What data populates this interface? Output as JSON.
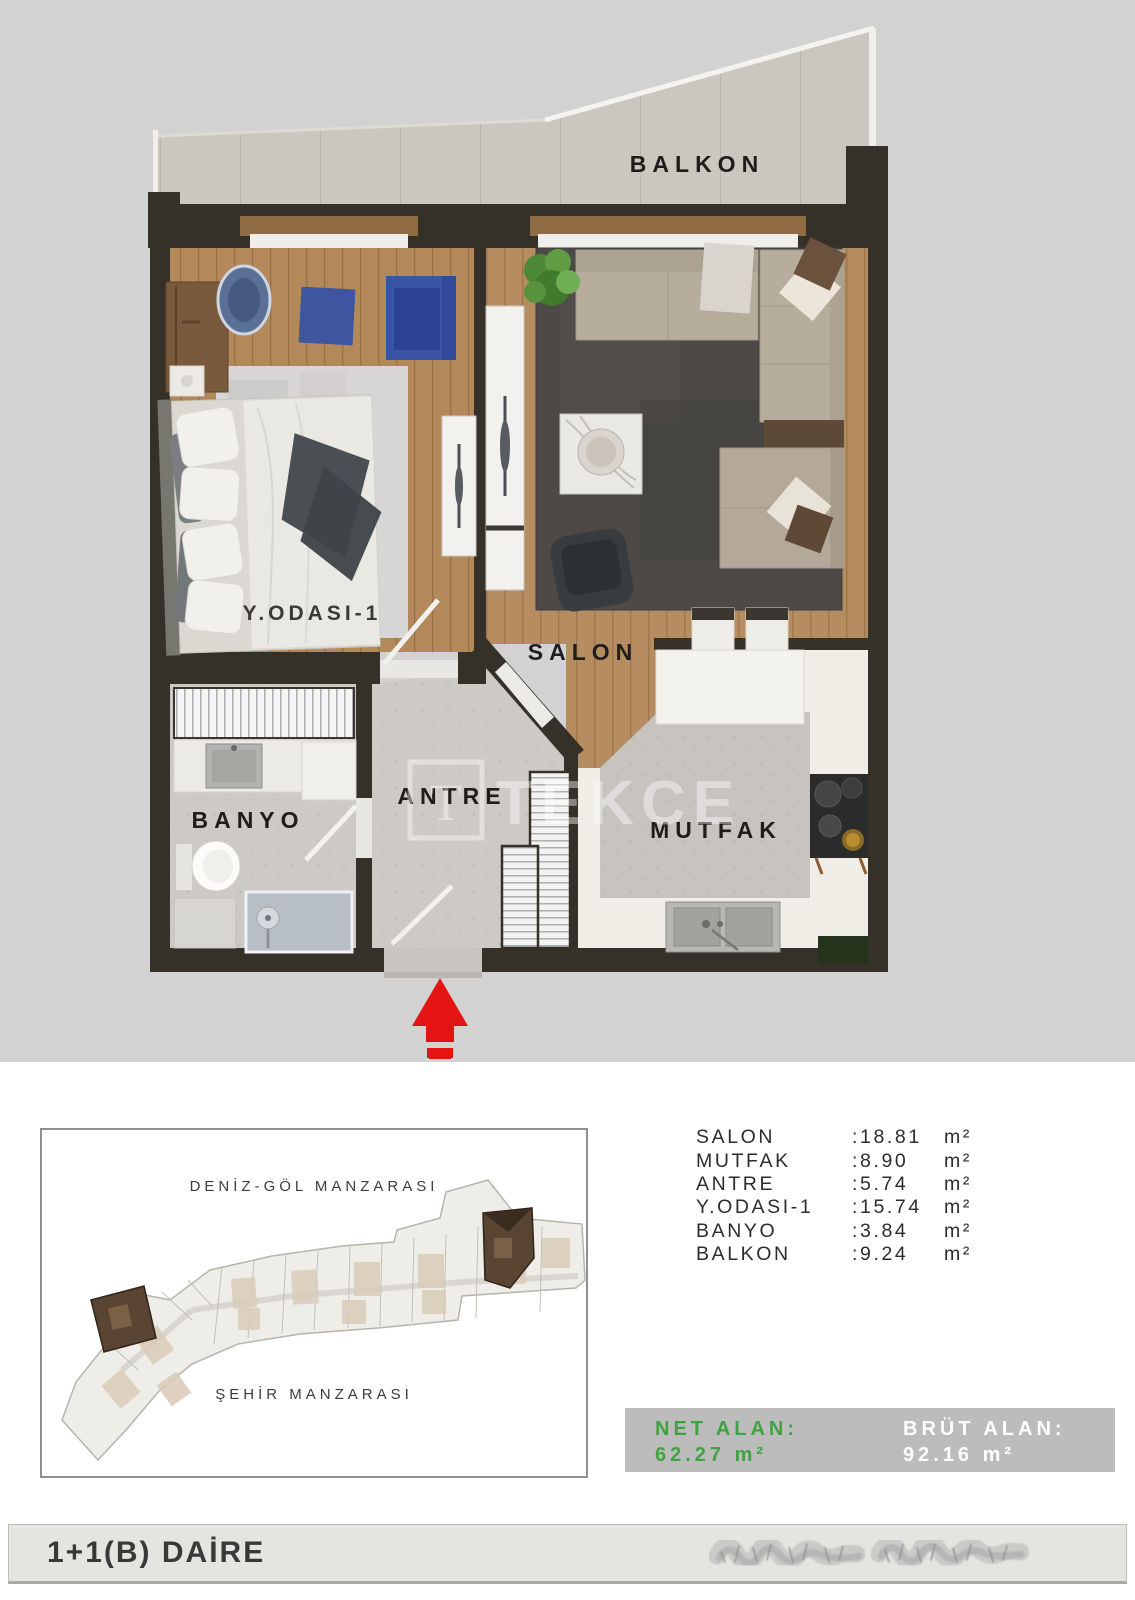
{
  "floor_plan": {
    "labels": {
      "balkon": "BALKON",
      "salon": "SALON",
      "bedroom": "Y.ODASI-1",
      "antre": "ANTRE",
      "banyo": "BANYO",
      "mutfak": "MUTFAK"
    },
    "watermark": {
      "logo_letter": "T",
      "text": "TEKCE"
    },
    "entrance_arrow_color": "#e41414"
  },
  "site_plan": {
    "sea_lake_view_label": "DENİZ-GÖL MANZARASI",
    "city_view_label": "ŞEHİR MANZARASI"
  },
  "areas": {
    "rows": [
      {
        "label": "SALON",
        "value": ":18.81",
        "unit": "m²"
      },
      {
        "label": "MUTFAK",
        "value": ":8.90",
        "unit": "m²"
      },
      {
        "label": "ANTRE",
        "value": ":5.74",
        "unit": "m²"
      },
      {
        "label": "Y.ODASI-1",
        "value": ":15.74",
        "unit": "m²"
      },
      {
        "label": "BANYO",
        "value": ":3.84",
        "unit": "m²"
      },
      {
        "label": "BALKON",
        "value": ":9.24",
        "unit": "m²"
      }
    ]
  },
  "summary": {
    "net_label": "NET ALAN:",
    "net_value": "62.27 m²",
    "net_color": "#3fa43f",
    "brut_label": "BRÜT ALAN:",
    "brut_value": "92.16 m²",
    "brut_color": "#ffffff"
  },
  "footer": {
    "unit_type": "1+1(B) DAİRE"
  }
}
